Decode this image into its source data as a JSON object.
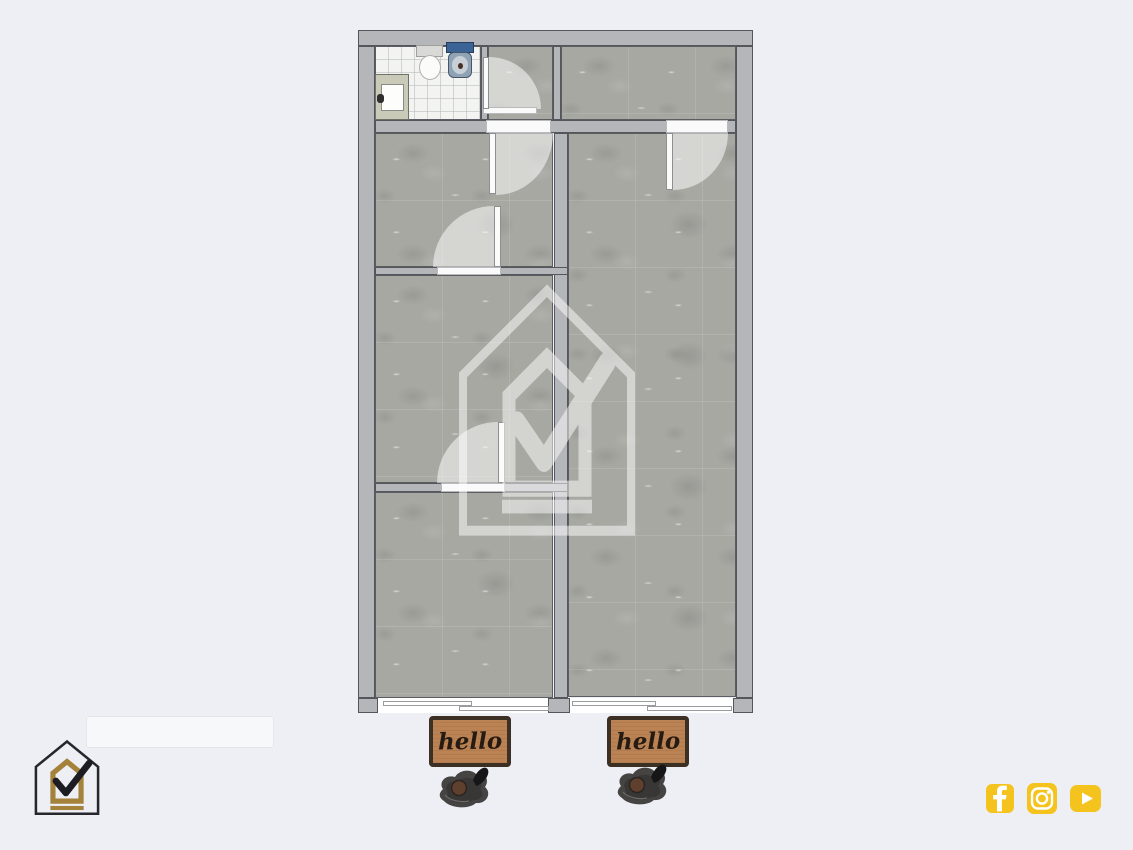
{
  "scene": {
    "type": "floor-plan-render",
    "background": "#edeff4"
  },
  "colors": {
    "wall": "#b5b6ba",
    "wall_outline": "#55565b",
    "floor_concrete": "#a7a8a2",
    "bathroom_tile": "#f3f4f2",
    "door_white": "#fbfbfa",
    "accent_yellow": "#f5c31e",
    "logo_gold": "#a5823c",
    "logo_black": "#26262c",
    "doormat_brown": "#bb8253",
    "doormat_border": "#3c2f23"
  },
  "floorplan": {
    "rooms_count": 7,
    "hinged_doors": 5,
    "sliding_doors": 2,
    "bathroom_fixtures": [
      "counter-sink",
      "toilet",
      "washbasin"
    ]
  },
  "watermark": {
    "icon": "house-check-logo"
  },
  "brand": {
    "icon": "house-check-logo"
  },
  "doormats": [
    {
      "text": "hello"
    },
    {
      "text": "hello"
    }
  ],
  "social": {
    "icons": [
      {
        "name": "facebook"
      },
      {
        "name": "instagram"
      },
      {
        "name": "youtube"
      }
    ]
  }
}
